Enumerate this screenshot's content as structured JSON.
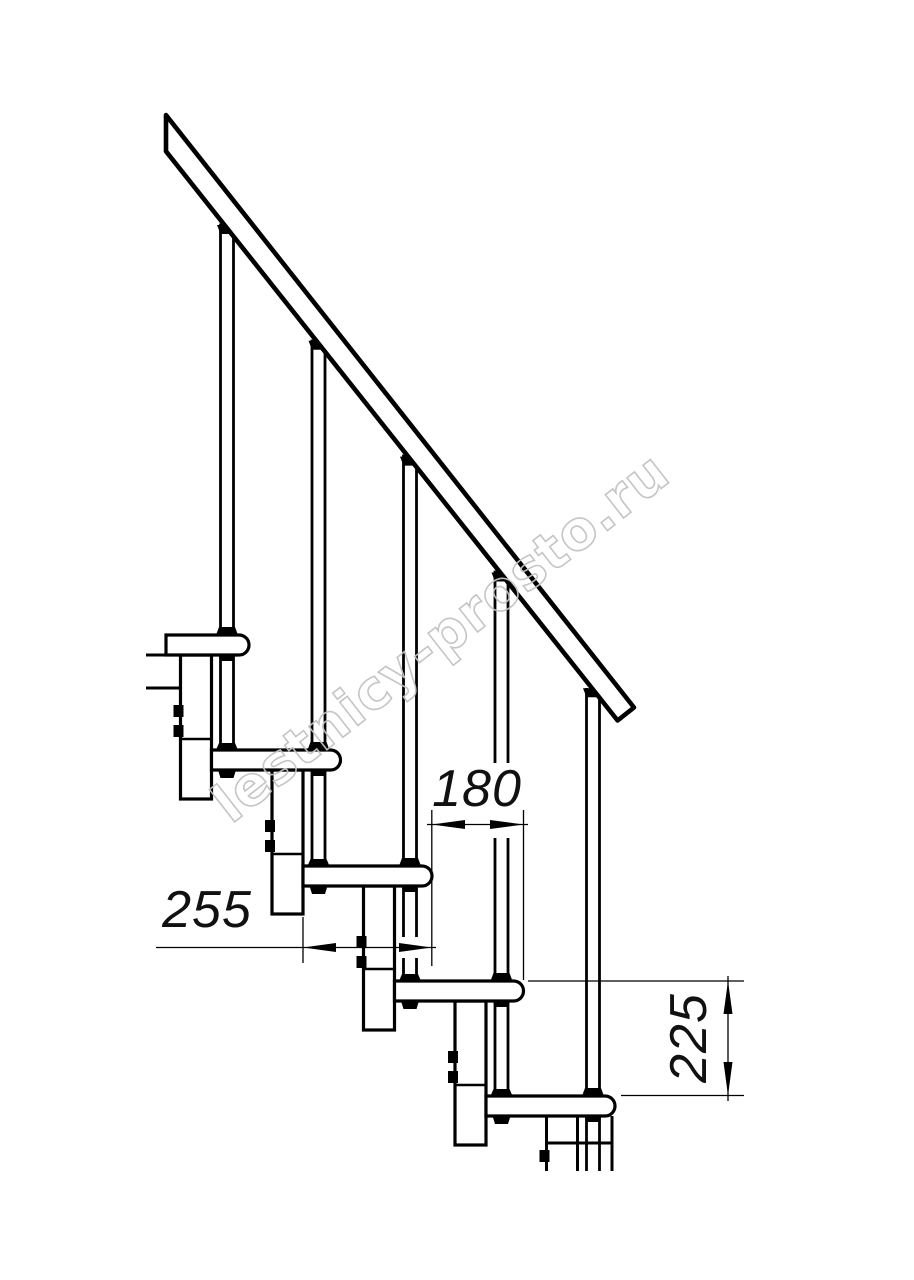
{
  "drawing": {
    "dimensions": {
      "step_run": "180",
      "tread_depth": "255",
      "riser_height": "225"
    },
    "watermark": "lestnicy-prosto.ru",
    "colors": {
      "line_color": "#000000",
      "watermark_color": "#c2c2c2",
      "background": "#ffffff"
    }
  }
}
